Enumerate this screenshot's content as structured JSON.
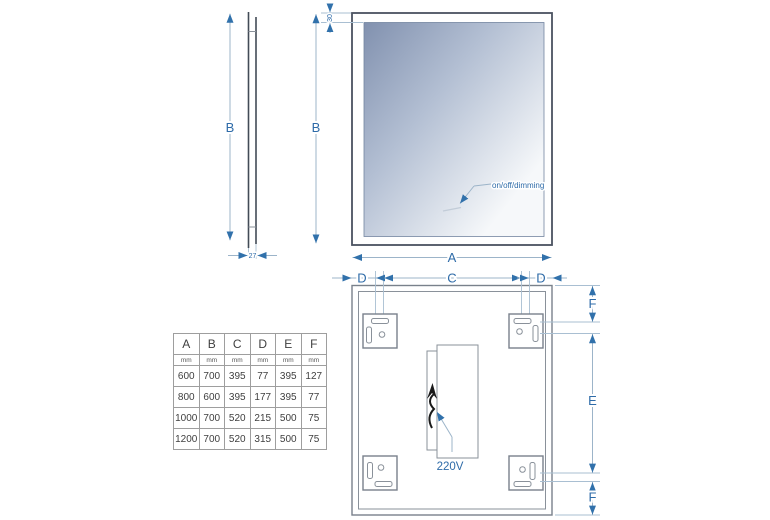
{
  "drawing": {
    "side_view": {
      "height_label": "B",
      "depth_label": "27"
    },
    "front_view": {
      "height_label": "B",
      "width_label": "A",
      "top_offset_label": "30",
      "sensor_note": "on/off/dimming"
    },
    "back_view": {
      "dim_d_left": "D",
      "dim_c": "C",
      "dim_d_right": "D",
      "dim_f_top": "F",
      "dim_e": "E",
      "dim_f_bottom": "F",
      "power_label": "220V"
    }
  },
  "colors": {
    "dimension_accent": "#2e6ba8",
    "dimension_line": "#9cb4c9",
    "frame_outline": "#4a5260",
    "back_outline": "#79818b",
    "glass_gradient_start": "#8191af",
    "glass_gradient_end": "#f6f8fa",
    "cable": "#1a1a1a"
  },
  "table": {
    "columns": [
      "A",
      "B",
      "C",
      "D",
      "E",
      "F"
    ],
    "units": [
      "mm",
      "mm",
      "mm",
      "mm",
      "mm",
      "mm"
    ],
    "rows": [
      [
        "600",
        "700",
        "395",
        "77",
        "395",
        "127"
      ],
      [
        "800",
        "600",
        "395",
        "177",
        "395",
        "77"
      ],
      [
        "1000",
        "700",
        "520",
        "215",
        "500",
        "75"
      ],
      [
        "1200",
        "700",
        "520",
        "315",
        "500",
        "75"
      ]
    ]
  }
}
